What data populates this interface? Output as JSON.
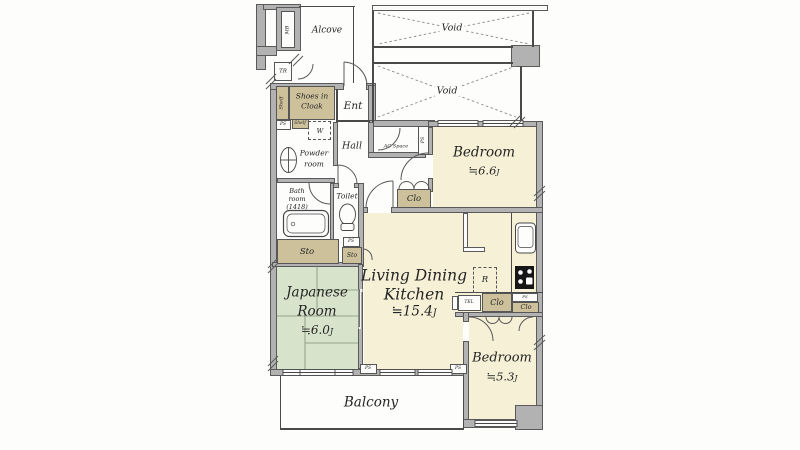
{
  "colors": {
    "room_cream": "#f5f0d6",
    "room_green": "#d8e3cc",
    "closet_tan": "#cdc19b",
    "wall_gray": "#b2b2b2",
    "line": "#4a4a4a"
  },
  "rooms": {
    "alcove": {
      "name": "Alcove"
    },
    "void": {
      "name": "Void"
    },
    "entrance": {
      "name": "Ent"
    },
    "hall": {
      "name": "Hall"
    },
    "shoes_in_cloak": {
      "line1": "Shoes in",
      "line2": "Cloak"
    },
    "powder_room": {
      "line1": "Powder",
      "line2": "room"
    },
    "bathroom": {
      "line1": "Bath",
      "line2": "room",
      "line3": "(1418)"
    },
    "toilet": {
      "name": "Toilet"
    },
    "ac_space": {
      "name": "AC Space"
    },
    "bedroom_1": {
      "name": "Bedroom",
      "size": "≒6.6",
      "unit": "J"
    },
    "ldk": {
      "line1": "Living Dining",
      "line2": "Kitchen",
      "size": "≒15.4",
      "unit": "J"
    },
    "japanese_room": {
      "line1": "Japanese",
      "line2": "Room",
      "size": "≒6.0",
      "unit": "J"
    },
    "bedroom_2": {
      "name": "Bedroom",
      "size": "≒5.3",
      "unit": "J"
    },
    "balcony": {
      "name": "Balcony"
    }
  },
  "fixtures": {
    "meter_box": "MB",
    "trunk_room": "TR",
    "shelf": "Shelf",
    "pipe_space": "PS",
    "washer": "W",
    "storage": "Sto",
    "closet": "Clo",
    "refrigerator": "R",
    "telephone": "TEL"
  }
}
